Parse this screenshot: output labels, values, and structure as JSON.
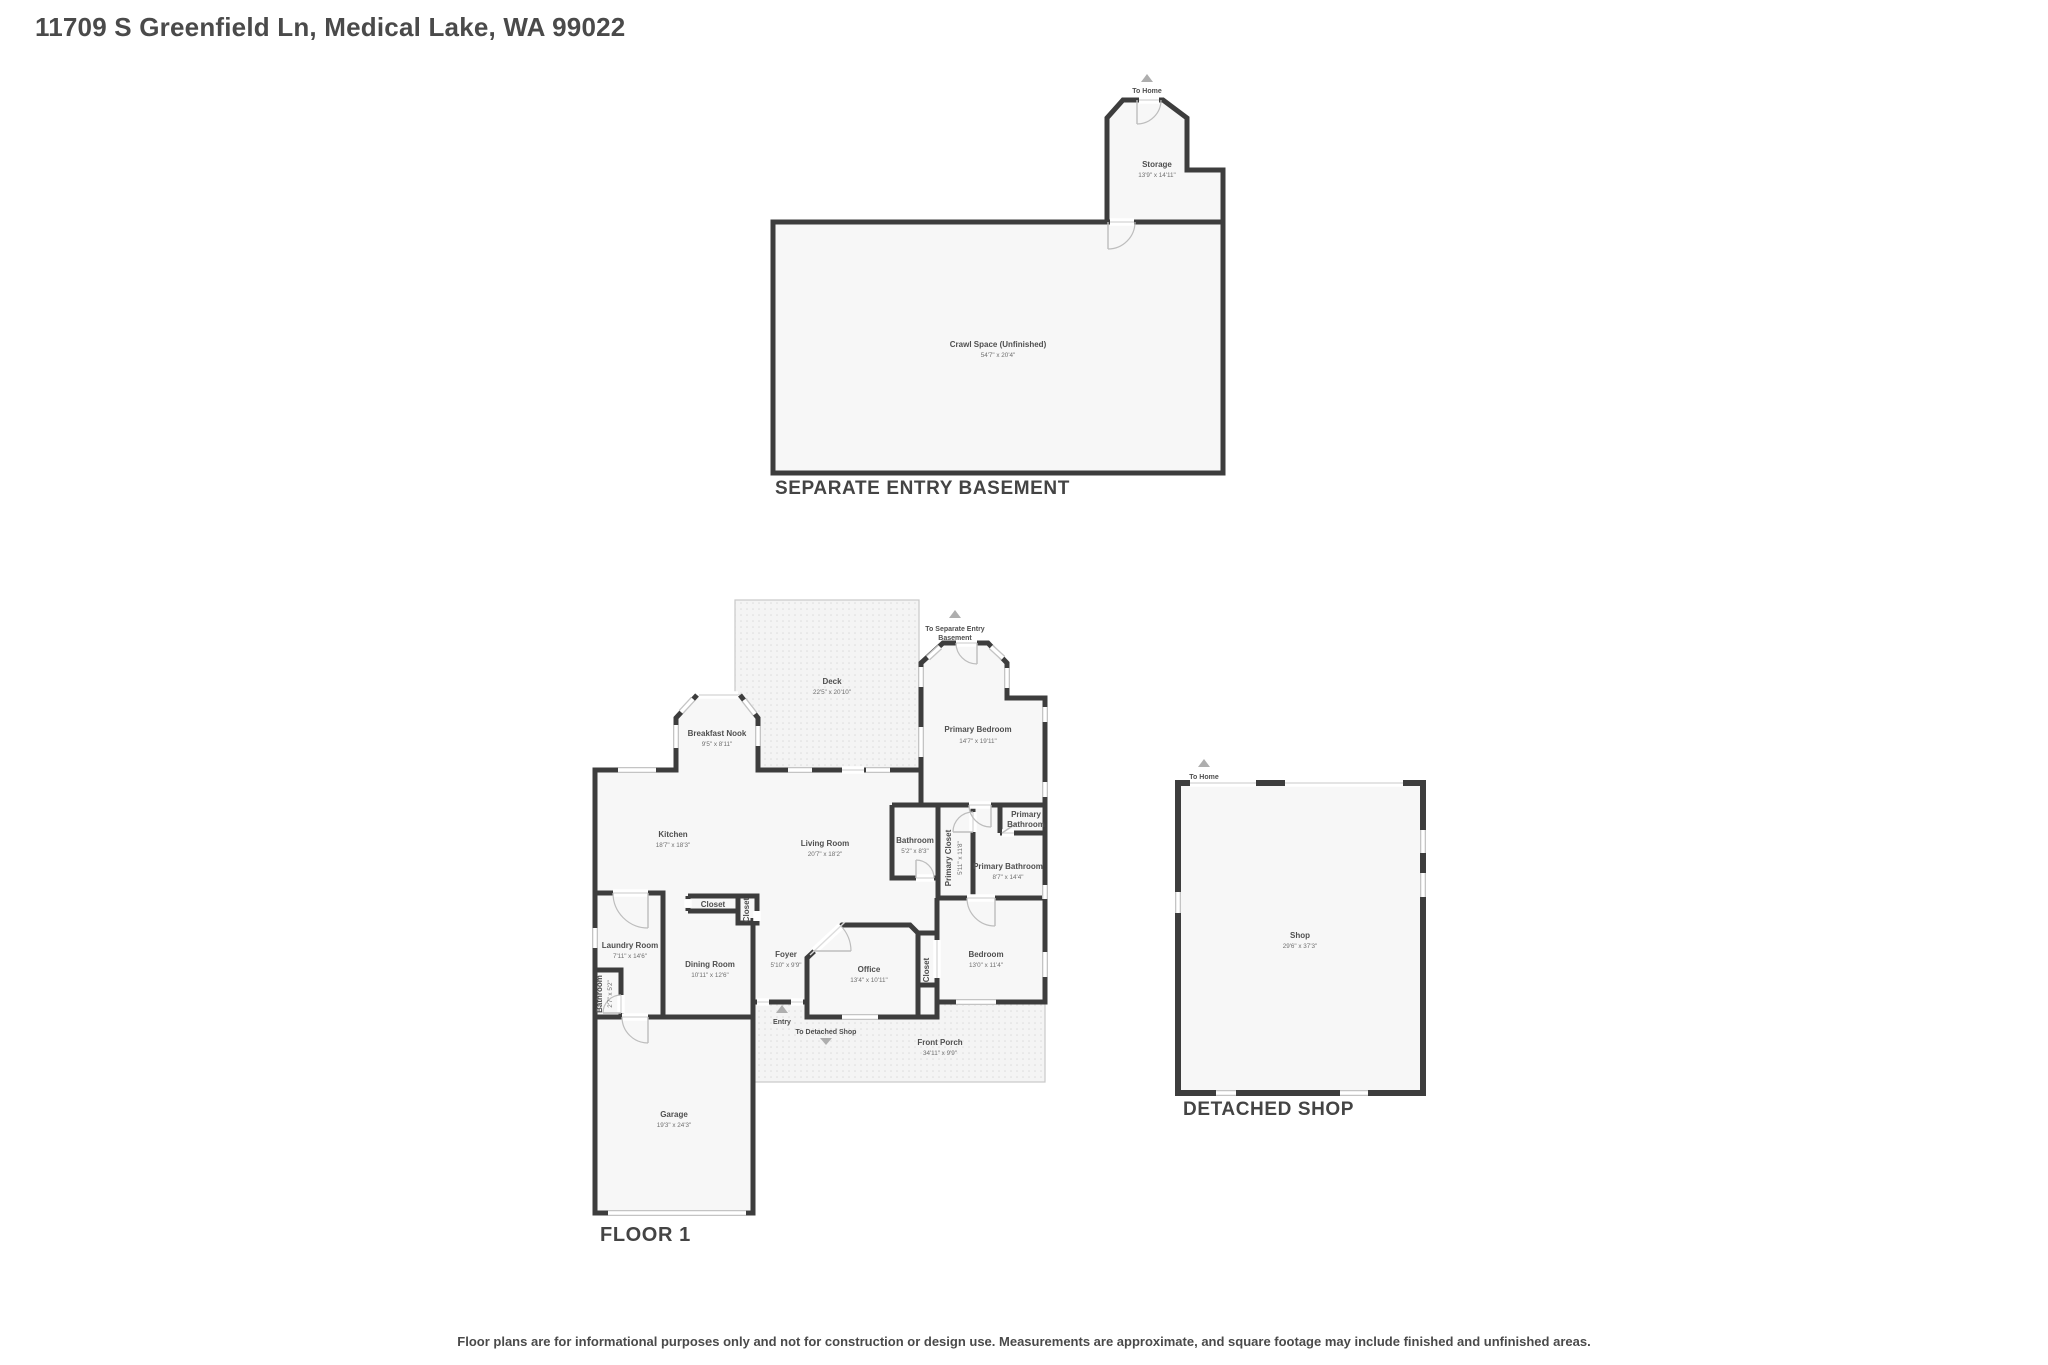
{
  "header": {
    "title": "11709 S Greenfield Ln, Medical Lake, WA 99022"
  },
  "footer": {
    "disclaimer": "Floor plans are for informational purposes only and not for construction or design use. Measurements are approximate, and square footage may include finished and unfinished areas."
  },
  "basement": {
    "title": "SEPARATE ENTRY BASEMENT",
    "to_home": "To Home",
    "rooms": {
      "storage": {
        "name": "Storage",
        "dims": "13'9\" x 14'11\""
      },
      "crawl_space": {
        "name": "Crawl Space (Unfinished)",
        "dims": "54'7\" x 20'4\""
      }
    }
  },
  "floor1": {
    "title": "FLOOR 1",
    "markers": {
      "to_basement_line1": "To Separate Entry",
      "to_basement_line2": "Basement",
      "entry": "Entry",
      "to_shop": "To Detached Shop"
    },
    "rooms": {
      "deck": {
        "name": "Deck",
        "dims": "22'5\" x 20'10\""
      },
      "breakfast_nook": {
        "name": "Breakfast Nook",
        "dims": "9'5\" x 8'11\""
      },
      "primary_bedroom": {
        "name": "Primary Bedroom",
        "dims": "14'7\" x 19'11\""
      },
      "kitchen": {
        "name": "Kitchen",
        "dims": "18'7\" x 18'3\""
      },
      "living_room": {
        "name": "Living Room",
        "dims": "20'7\" x 18'2\""
      },
      "bathroom_main": {
        "name": "Bathroom",
        "dims": "5'2\" x 8'3\""
      },
      "primary_closet": {
        "name": "Primary Closet",
        "dims": "5'11\" x 11'8\""
      },
      "primary_bathroom_label": {
        "line1": "Primary",
        "line2": "Bathroom"
      },
      "primary_bathroom": {
        "name": "Primary Bathroom",
        "dims": "8'7\" x 14'4\""
      },
      "laundry": {
        "name": "Laundry Room",
        "dims": "7'11\" x 14'6\""
      },
      "bathroom_small": {
        "name": "Bathroom",
        "dims": "2'7\" x 5'2\""
      },
      "dining": {
        "name": "Dining Room",
        "dims": "10'11\" x 12'6\""
      },
      "closet_hall": {
        "name": "Closet"
      },
      "closet_foyer": {
        "name": "Closet"
      },
      "foyer": {
        "name": "Foyer",
        "dims": "5'10\" x 9'9\""
      },
      "office": {
        "name": "Office",
        "dims": "13'4\" x 10'11\""
      },
      "closet_bedroom": {
        "name": "Closet"
      },
      "bedroom": {
        "name": "Bedroom",
        "dims": "13'0\" x 11'4\""
      },
      "front_porch": {
        "name": "Front Porch",
        "dims": "34'11\" x 9'9\""
      },
      "garage": {
        "name": "Garage",
        "dims": "19'3\" x 24'3\""
      }
    }
  },
  "shop": {
    "title": "DETACHED SHOP",
    "to_home": "To Home",
    "rooms": {
      "shop": {
        "name": "Shop",
        "dims": "29'6\" x 37'3\""
      }
    }
  }
}
